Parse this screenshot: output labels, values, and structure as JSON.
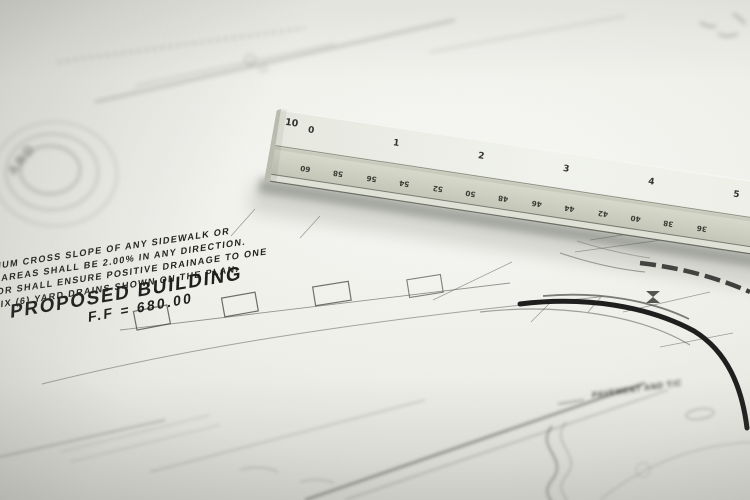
{
  "plan": {
    "notes": {
      "line1": "XIMUM CROSS SLOPE OF ANY SIDEWALK OR",
      "line2": "CK AREAS SHALL BE 2.00% IN ANY DIRECTION.",
      "line3": "CTOR SHALL ENSURE POSITIVE DRAINAGE TO ONE",
      "line4": "E SIX (6) YARD DRAINS SHOWN ON THE PLAN."
    },
    "building_label": "PROPOSED BUILDING",
    "finished_floor": "F.F = 680.00",
    "yard_label": "ARD",
    "pavement_label": "PAVEMENT AND T/C"
  },
  "ruler": {
    "scale_label": "10",
    "top_numbers": [
      "0",
      "1",
      "2",
      "3",
      "4",
      "5"
    ],
    "bottom_numbers": [
      "60",
      "58",
      "56",
      "54",
      "52",
      "50",
      "48",
      "46",
      "44",
      "42",
      "40",
      "38",
      "36"
    ]
  },
  "colors": {
    "paper": "#eff0ea",
    "ink": "#22221f",
    "ruler_top_face": "#f2f3ee",
    "ruler_front_face": "#cfd1c3",
    "ruler_shadow": "#4e5148"
  }
}
